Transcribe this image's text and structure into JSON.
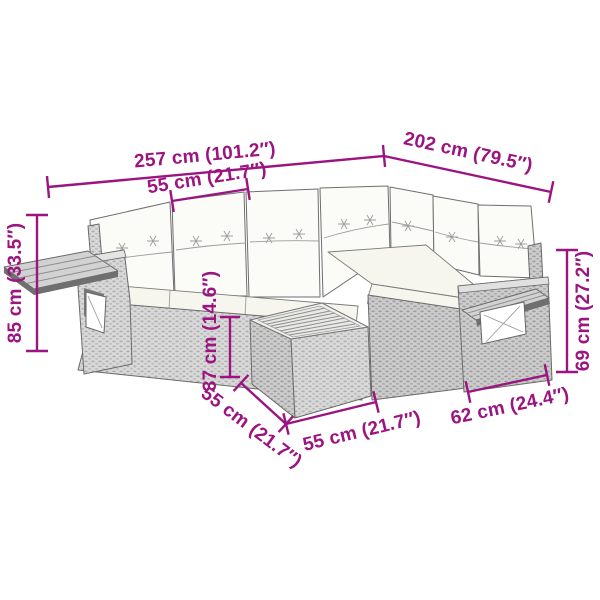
{
  "figure": {
    "kind": "product-dimension-diagram",
    "subject": "modular-rattan-corner-sofa-set-with-side-table",
    "accent_color": "#9B1480",
    "background_color": "#FFFFFF",
    "sofa_body_color": "#D8D8D8",
    "cushion_color": "#FBFBF8"
  },
  "dims": {
    "total_width": "257 cm (101.2″)",
    "total_depth": "202 cm (79.5″)",
    "seat_width": "55 cm (21.7″)",
    "back_height": "85 cm (33.5″)",
    "arm_height": "69 cm (27.2″)",
    "table_height": "37 cm (14.6″)",
    "table_depth": "55 cm (21.7″)",
    "table_width": "55 cm (21.7″)",
    "end_section_width": "62 cm (24.4″)"
  }
}
